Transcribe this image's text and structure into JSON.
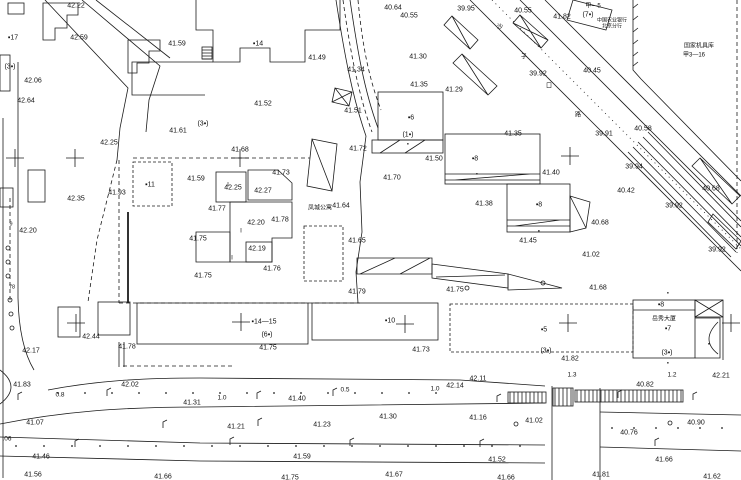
{
  "map": {
    "colors": {
      "ink": "#1b1b1b",
      "background": "#ffffff"
    },
    "place_names": {
      "apartment": "凤城公寓",
      "bank_line1": "中国农业银行",
      "bank_line2": "北京分行",
      "depot_line1": "国家机具库",
      "depot_line2": "甲3—16",
      "tower_name": "岳秀大厦",
      "street_chars": [
        "沙",
        "子",
        "口",
        "路"
      ]
    },
    "labels": [
      {
        "t": "42.22",
        "x": 76,
        "y": 5,
        "c": "el"
      },
      {
        "t": "42.59",
        "x": 79,
        "y": 37,
        "c": "el"
      },
      {
        "t": "▪17",
        "x": 13,
        "y": 37,
        "c": "bl"
      },
      {
        "t": "(3▪)",
        "x": 10,
        "y": 66,
        "c": "bl"
      },
      {
        "t": "42.06",
        "x": 33,
        "y": 80,
        "c": "el"
      },
      {
        "t": "42.64",
        "x": 26,
        "y": 100,
        "c": "el"
      },
      {
        "t": "41.59",
        "x": 177,
        "y": 43,
        "c": "el"
      },
      {
        "t": "42.25",
        "x": 109,
        "y": 142,
        "c": "el"
      },
      {
        "t": "41.61",
        "x": 178,
        "y": 130,
        "c": "el"
      },
      {
        "t": "(3▪)",
        "x": 203,
        "y": 123,
        "c": "bl"
      },
      {
        "t": "▪14",
        "x": 258,
        "y": 43,
        "c": "bl"
      },
      {
        "t": "41.52",
        "x": 263,
        "y": 103,
        "c": "el"
      },
      {
        "t": "41.49",
        "x": 317,
        "y": 57,
        "c": "el"
      },
      {
        "t": "41.51",
        "x": 353,
        "y": 110,
        "c": "el"
      },
      {
        "t": "40.64",
        "x": 393,
        "y": 7,
        "c": "el"
      },
      {
        "t": "40.55",
        "x": 409,
        "y": 15,
        "c": "el"
      },
      {
        "t": "39.95",
        "x": 466,
        "y": 8,
        "c": "el"
      },
      {
        "t": "41.34",
        "x": 356,
        "y": 69,
        "c": "el"
      },
      {
        "t": "41.30",
        "x": 418,
        "y": 56,
        "c": "el"
      },
      {
        "t": "41.35",
        "x": 419,
        "y": 84,
        "c": "el"
      },
      {
        "t": "41.29",
        "x": 454,
        "y": 89,
        "c": "el"
      },
      {
        "t": "41.72",
        "x": 358,
        "y": 148,
        "c": "el"
      },
      {
        "t": "41.50",
        "x": 434,
        "y": 158,
        "c": "el"
      },
      {
        "t": "▪6",
        "x": 411,
        "y": 117,
        "c": "bl"
      },
      {
        "t": "(1▪)",
        "x": 408,
        "y": 134,
        "c": "bl"
      },
      {
        "t": "40.55",
        "x": 523,
        "y": 10,
        "c": "el"
      },
      {
        "t": "41.82",
        "x": 562,
        "y": 16,
        "c": "el"
      },
      {
        "t": "甲—5",
        "x": 593,
        "y": 5,
        "c": "cn"
      },
      {
        "t": "(7▪)",
        "x": 588,
        "y": 14,
        "c": "bl"
      },
      {
        "t": "中国农业银行",
        "x": 612,
        "y": 19,
        "c": "cns"
      },
      {
        "t": "北京分行",
        "x": 612,
        "y": 25,
        "c": "cns"
      },
      {
        "t": "国家机具库",
        "x": 699,
        "y": 45,
        "c": "cn"
      },
      {
        "t": "甲3—16",
        "x": 694,
        "y": 54,
        "c": "cn"
      },
      {
        "t": "40.45",
        "x": 592,
        "y": 70,
        "c": "el"
      },
      {
        "t": "39.92",
        "x": 538,
        "y": 73,
        "c": "el"
      },
      {
        "t": "沙",
        "x": 500,
        "y": 26,
        "c": "cn"
      },
      {
        "t": "子",
        "x": 524,
        "y": 56,
        "c": "cn"
      },
      {
        "t": "口",
        "x": 549,
        "y": 85,
        "c": "cn"
      },
      {
        "t": "路",
        "x": 578,
        "y": 114,
        "c": "cn"
      },
      {
        "t": "40.58",
        "x": 643,
        "y": 128,
        "c": "el"
      },
      {
        "t": "39.91",
        "x": 604,
        "y": 133,
        "c": "el"
      },
      {
        "t": "39.94",
        "x": 634,
        "y": 166,
        "c": "el"
      },
      {
        "t": "41.40",
        "x": 551,
        "y": 172,
        "c": "el"
      },
      {
        "t": "40.42",
        "x": 626,
        "y": 190,
        "c": "el"
      },
      {
        "t": "40.68",
        "x": 711,
        "y": 188,
        "c": "el"
      },
      {
        "t": "39.92",
        "x": 674,
        "y": 205,
        "c": "el"
      },
      {
        "t": "40.68",
        "x": 600,
        "y": 222,
        "c": "el"
      },
      {
        "t": "▪8",
        "x": 539,
        "y": 204,
        "c": "bl"
      },
      {
        "t": "41.45",
        "x": 528,
        "y": 240,
        "c": "el"
      },
      {
        "t": "39.92",
        "x": 717,
        "y": 249,
        "c": "el"
      },
      {
        "t": "41.02",
        "x": 591,
        "y": 254,
        "c": "el"
      },
      {
        "t": "41.68",
        "x": 598,
        "y": 287,
        "c": "el"
      },
      {
        "t": "41.35",
        "x": 513,
        "y": 133,
        "c": "el"
      },
      {
        "t": "41.38",
        "x": 484,
        "y": 203,
        "c": "el"
      },
      {
        "t": "▪8",
        "x": 475,
        "y": 158,
        "c": "bl"
      },
      {
        "t": "41.93",
        "x": 117,
        "y": 192,
        "c": "el"
      },
      {
        "t": "▪11",
        "x": 150,
        "y": 184,
        "c": "bl"
      },
      {
        "t": "42.35",
        "x": 76,
        "y": 198,
        "c": "el"
      },
      {
        "t": "42.20",
        "x": 28,
        "y": 230,
        "c": "el"
      },
      {
        "t": "9",
        "x": 11,
        "y": 223,
        "c": "tiny"
      },
      {
        "t": "78",
        "x": 12,
        "y": 286,
        "c": "tiny"
      },
      {
        "t": "41.68",
        "x": 240,
        "y": 149,
        "c": "el"
      },
      {
        "t": "41.73",
        "x": 281,
        "y": 172,
        "c": "el"
      },
      {
        "t": "41.59",
        "x": 196,
        "y": 178,
        "c": "el"
      },
      {
        "t": "42.25",
        "x": 233,
        "y": 187,
        "c": "el"
      },
      {
        "t": "42.27",
        "x": 263,
        "y": 190,
        "c": "el"
      },
      {
        "t": "41.77",
        "x": 217,
        "y": 208,
        "c": "el"
      },
      {
        "t": "42.20",
        "x": 256,
        "y": 222,
        "c": "el"
      },
      {
        "t": "41.78",
        "x": 280,
        "y": 219,
        "c": "el"
      },
      {
        "t": "41.75",
        "x": 198,
        "y": 238,
        "c": "el"
      },
      {
        "t": "42.19",
        "x": 257,
        "y": 248,
        "c": "el"
      },
      {
        "t": "41.76",
        "x": 272,
        "y": 268,
        "c": "el"
      },
      {
        "t": "41.75",
        "x": 203,
        "y": 275,
        "c": "el"
      },
      {
        "t": "凤城公寓",
        "x": 320,
        "y": 207,
        "c": "cn"
      },
      {
        "t": "41.64",
        "x": 341,
        "y": 205,
        "c": "el"
      },
      {
        "t": "41.65",
        "x": 357,
        "y": 240,
        "c": "el"
      },
      {
        "t": "41.70",
        "x": 392,
        "y": 177,
        "c": "el"
      },
      {
        "t": "41.79",
        "x": 357,
        "y": 291,
        "c": "el"
      },
      {
        "t": "41.75",
        "x": 455,
        "y": 289,
        "c": "el"
      },
      {
        "t": "▪14—15",
        "x": 264,
        "y": 321,
        "c": "bl"
      },
      {
        "t": "(6▪)",
        "x": 267,
        "y": 334,
        "c": "bl"
      },
      {
        "t": "41.75",
        "x": 268,
        "y": 347,
        "c": "el"
      },
      {
        "t": "▪10",
        "x": 390,
        "y": 320,
        "c": "bl"
      },
      {
        "t": "41.73",
        "x": 421,
        "y": 349,
        "c": "el"
      },
      {
        "t": "▪5",
        "x": 544,
        "y": 329,
        "c": "bl"
      },
      {
        "t": "(3▪)",
        "x": 546,
        "y": 350,
        "c": "bl"
      },
      {
        "t": "41.82",
        "x": 570,
        "y": 358,
        "c": "el"
      },
      {
        "t": "▪8",
        "x": 661,
        "y": 304,
        "c": "bl"
      },
      {
        "t": "岳秀大厦",
        "x": 664,
        "y": 318,
        "c": "cn"
      },
      {
        "t": "▪7",
        "x": 668,
        "y": 328,
        "c": "bl"
      },
      {
        "t": "(3▪)",
        "x": 667,
        "y": 352,
        "c": "bl"
      },
      {
        "t": "▪",
        "x": 668,
        "y": 362,
        "c": "tiny"
      },
      {
        "t": "42.21",
        "x": 721,
        "y": 375,
        "c": "el"
      },
      {
        "t": "1.3",
        "x": 572,
        "y": 374,
        "c": "dim"
      },
      {
        "t": "1.2",
        "x": 672,
        "y": 374,
        "c": "dim"
      },
      {
        "t": "40.82",
        "x": 645,
        "y": 384,
        "c": "el"
      },
      {
        "t": "42.44",
        "x": 91,
        "y": 336,
        "c": "el"
      },
      {
        "t": "42.17",
        "x": 31,
        "y": 350,
        "c": "el"
      },
      {
        "t": "41.78",
        "x": 127,
        "y": 346,
        "c": "el"
      },
      {
        "t": "41.83",
        "x": 22,
        "y": 384,
        "c": "el"
      },
      {
        "t": "0.8",
        "x": 60,
        "y": 394,
        "c": "dim"
      },
      {
        "t": "42.02",
        "x": 130,
        "y": 384,
        "c": "el"
      },
      {
        "t": "1.0",
        "x": 222,
        "y": 397,
        "c": "dim"
      },
      {
        "t": "0.5",
        "x": 345,
        "y": 389,
        "c": "dim"
      },
      {
        "t": "1.0",
        "x": 435,
        "y": 388,
        "c": "dim"
      },
      {
        "t": "42.14",
        "x": 455,
        "y": 385,
        "c": "el"
      },
      {
        "t": "42.11",
        "x": 478,
        "y": 378,
        "c": "el"
      },
      {
        "t": "41.31",
        "x": 192,
        "y": 402,
        "c": "el"
      },
      {
        "t": "41.07",
        "x": 35,
        "y": 422,
        "c": "el"
      },
      {
        "t": "41.21",
        "x": 236,
        "y": 426,
        "c": "el"
      },
      {
        "t": ".06",
        "x": 7,
        "y": 438,
        "c": "dim"
      },
      {
        "t": "41.46",
        "x": 41,
        "y": 456,
        "c": "el"
      },
      {
        "t": "41.56",
        "x": 33,
        "y": 474,
        "c": "el"
      },
      {
        "t": "41.66",
        "x": 163,
        "y": 476,
        "c": "el"
      },
      {
        "t": "41.40",
        "x": 297,
        "y": 398,
        "c": "el"
      },
      {
        "t": "41.23",
        "x": 322,
        "y": 424,
        "c": "el"
      },
      {
        "t": "41.30",
        "x": 388,
        "y": 416,
        "c": "el"
      },
      {
        "t": "41.16",
        "x": 478,
        "y": 417,
        "c": "el"
      },
      {
        "t": "41.59",
        "x": 302,
        "y": 456,
        "c": "el"
      },
      {
        "t": "41.75",
        "x": 290,
        "y": 477,
        "c": "el"
      },
      {
        "t": "41.67",
        "x": 394,
        "y": 474,
        "c": "el"
      },
      {
        "t": "41.02",
        "x": 534,
        "y": 420,
        "c": "el"
      },
      {
        "t": "40.90",
        "x": 696,
        "y": 422,
        "c": "el"
      },
      {
        "t": "40.76",
        "x": 629,
        "y": 432,
        "c": "el"
      },
      {
        "t": "41.52",
        "x": 497,
        "y": 459,
        "c": "el"
      },
      {
        "t": "41.66",
        "x": 664,
        "y": 459,
        "c": "el"
      },
      {
        "t": "41.81",
        "x": 601,
        "y": 474,
        "c": "el"
      },
      {
        "t": "41.62",
        "x": 712,
        "y": 476,
        "c": "el"
      },
      {
        "t": "41.66",
        "x": 506,
        "y": 477,
        "c": "el"
      },
      {
        "t": "▪",
        "x": 539,
        "y": 230,
        "c": "tiny"
      },
      {
        "t": "▪",
        "x": 477,
        "y": 173,
        "c": "tiny"
      },
      {
        "t": "▪",
        "x": 709,
        "y": 343,
        "c": "tiny"
      },
      {
        "t": "▪",
        "x": 668,
        "y": 292,
        "c": "tiny"
      },
      {
        "t": "▪",
        "x": 408,
        "y": 143,
        "c": "tiny"
      },
      {
        "t": "∥",
        "x": 228,
        "y": 183,
        "c": "tick"
      },
      {
        "t": "∥",
        "x": 241,
        "y": 229,
        "c": "tick"
      },
      {
        "t": "∥",
        "x": 232,
        "y": 256,
        "c": "tick"
      }
    ],
    "crosses": [
      [
        15,
        158
      ],
      [
        75,
        158
      ],
      [
        240,
        158
      ],
      [
        570,
        156
      ],
      [
        76,
        323
      ],
      [
        241,
        322
      ],
      [
        405,
        324
      ],
      [
        568,
        323
      ],
      [
        731,
        323
      ]
    ],
    "poles": [
      [
        107,
        393
      ],
      [
        257,
        396
      ],
      [
        333,
        393
      ],
      [
        18,
        397
      ],
      [
        497,
        399
      ],
      [
        618,
        395
      ],
      [
        693,
        397
      ],
      [
        230,
        442
      ],
      [
        350,
        443
      ],
      [
        480,
        444
      ],
      [
        655,
        443
      ],
      [
        75,
        444
      ],
      [
        163,
        425
      ],
      [
        258,
        423
      ]
    ],
    "manholes": [
      [
        467,
        288
      ],
      [
        516,
        424
      ],
      [
        670,
        423
      ],
      [
        543,
        283
      ],
      [
        8,
        248
      ],
      [
        8,
        262
      ],
      [
        8,
        276
      ],
      [
        10,
        300
      ],
      [
        11,
        314
      ],
      [
        12,
        328
      ]
    ]
  }
}
